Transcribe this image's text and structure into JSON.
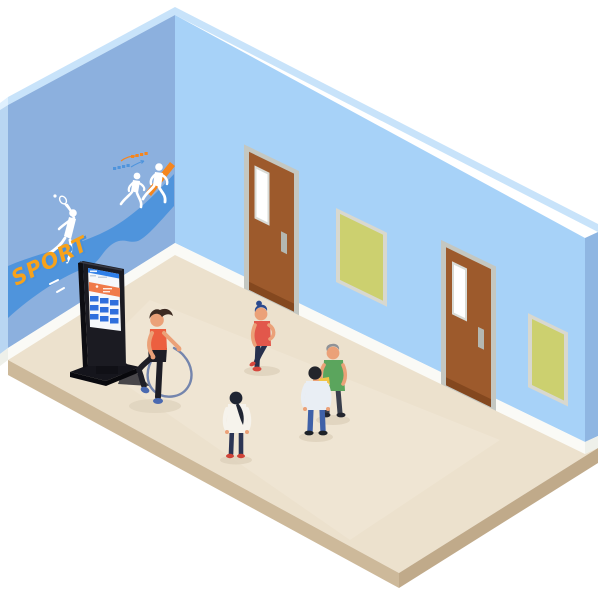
{
  "scene": {
    "description": "Isometric illustration of a sports hall interior with a wall mural, information kiosk, two doors, two notice boards and five people",
    "mural": {
      "sport_text": "SPORT",
      "slogan_marks_legible": false
    },
    "objects": {
      "doors_count": 2,
      "posters_count": 2,
      "kiosk": "free-standing digital signage totem"
    },
    "people": [
      {
        "id": "jump-rope-woman",
        "activity": "jumping rope"
      },
      {
        "id": "standing-woman",
        "activity": "standing, hand on hip"
      },
      {
        "id": "ponytail-girl",
        "activity": "standing, seen from behind"
      },
      {
        "id": "green-shirt-man",
        "activity": "holding yellow folder"
      },
      {
        "id": "back-turned-man",
        "activity": "talking, seen from behind"
      }
    ]
  },
  "colors": {
    "background": "#ffffff",
    "left_wall": "#8cb0de",
    "left_wall_edge": "#b9d6f2",
    "wall_cap": "#c8e3fa",
    "wall_cap_light": "#dff0fe",
    "right_wall": "#a7d2f8",
    "right_wall_edge": "#8fb6e2",
    "baseboard": "#fafaf6",
    "floor": "#ece1cd",
    "floor_highlight": "#f2e8d7",
    "floor_side_left": "#cdb99a",
    "floor_side_right": "#c0aa8a",
    "wave": "#4f94dc",
    "accent_orange": "#f5861f",
    "sport_orange": "#f7a21b",
    "sport_blue": "#4a90d9",
    "silhouette": "#ffffff",
    "door": "#9d5a2c",
    "door_dark": "#84481f",
    "door_frame": "#c4c7c1",
    "door_window_frame": "#d9dbd6",
    "door_window": "#ffffff",
    "door_plate": "#b4b7b1",
    "poster": "#ccd06f",
    "poster_frame": "#d8d8cf",
    "kiosk_body": "#1b1b22",
    "kiosk_side": "#0d0d12",
    "kiosk_base": "#15151c",
    "kiosk_screen": "#f6f8fb",
    "kiosk_header": "#2f7fe8",
    "kiosk_banner": "#f07a4a",
    "kiosk_tile": "#2f6fdd",
    "skin": "#eba178",
    "shadow": "#ddd1bc",
    "rope": "#7485ad",
    "p1_top": "#ec5f40",
    "p1_pants": "#1e1e26",
    "p1_shoes": "#4a69b0",
    "p1_hair": "#3d2b22",
    "p2_top": "#e2574b",
    "p2_pants": "#27304d",
    "p2_shoes": "#d6473d",
    "p2_hair": "#2b4a8f",
    "p3_top": "#f6f3ec",
    "p3_pants": "#2c3554",
    "p3_shoes": "#cf4338",
    "p3_hair": "#1f2533",
    "p4_top": "#5ba55d",
    "p4_pants": "#3a3f4c",
    "p4_shoes": "#23252e",
    "p4_hair": "#8f9297",
    "p4_folder": "#f2c445",
    "p5_top": "#e9eef4",
    "p5_pants": "#3f61a8",
    "p5_shoes": "#1c2026",
    "p5_hair": "#23252b"
  }
}
